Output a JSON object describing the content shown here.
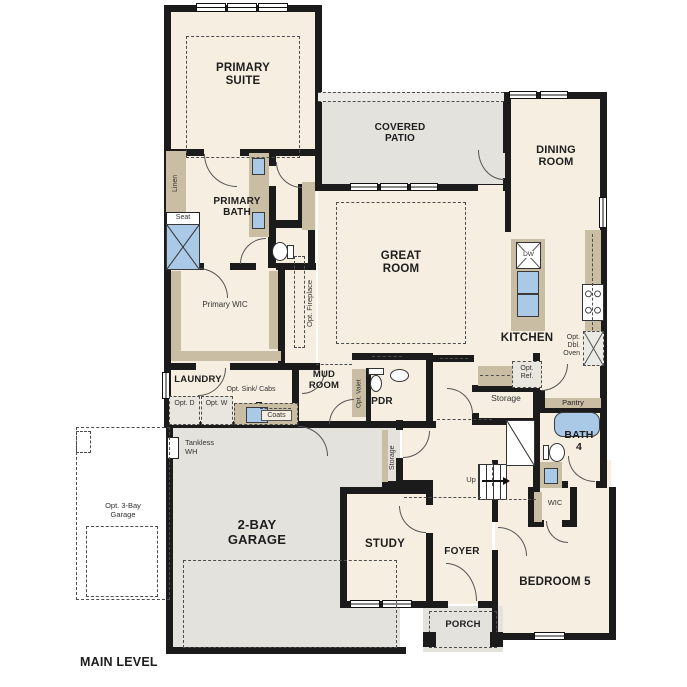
{
  "title": "MAIN LEVEL",
  "colors": {
    "floor": "#f6efe1",
    "wall": "#1b1b1b",
    "cabinet": "#c9bda3",
    "concrete": "#e4e2dd",
    "fixture": "#aac9e7"
  },
  "labels": {
    "primary_suite": "PRIMARY SUITE",
    "primary_bath": "PRIMARY BATH",
    "primary_wic": "Primary WIC",
    "linen": "Linen",
    "seat": "Seat",
    "covered_patio": "COVERED PATIO",
    "dining_room": "DINING ROOM",
    "great_room": "GREAT ROOM",
    "opt_fireplace": "Opt. Fireplace",
    "kitchen": "KITCHEN",
    "dw": "DW",
    "opt_dbl_oven": "Opt. Dbl. Oven",
    "opt_ref": "Opt. Ref.",
    "laundry": "LAUNDRY",
    "opt_d": "Opt. D",
    "opt_w": "Opt. W",
    "opt_sink_cabs": "Opt. Sink/ Cabs",
    "coats": "Coats",
    "mud_room": "MUD ROOM",
    "opt_valet": "Opt. Valet",
    "pdr": "PDR",
    "storage_room": "Storage",
    "storage_closet": "Storage",
    "pantry": "Pantry",
    "bath_4": "BATH 4",
    "wic": "WIC",
    "up": "Up",
    "tankless_wh": "Tankless WH",
    "garage": "2-BAY GARAGE",
    "opt_3bay_garage": "Opt. 3-Bay Garage",
    "study": "STUDY",
    "foyer": "FOYER",
    "porch": "PORCH",
    "bedroom_5": "BEDROOM 5",
    "main_level": "MAIN LEVEL"
  }
}
